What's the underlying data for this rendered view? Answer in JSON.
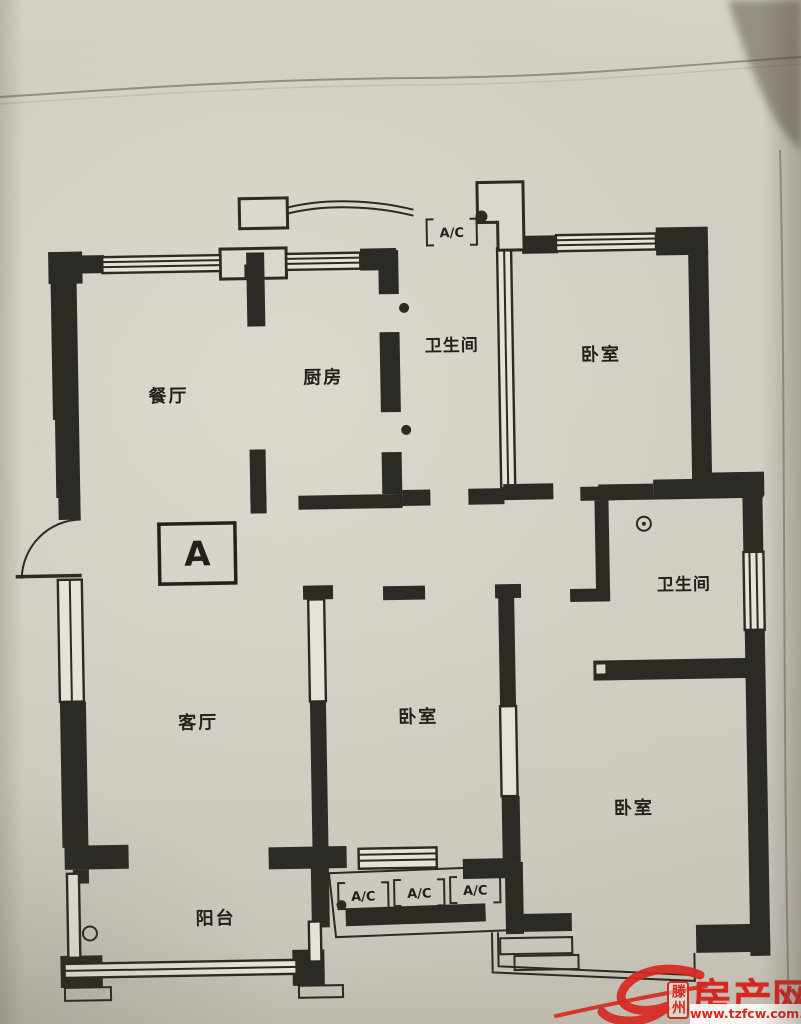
{
  "floorplan": {
    "unit_label": "A",
    "ac_label": "A/C",
    "rooms": [
      {
        "name": "dining-room",
        "label": "餐厅"
      },
      {
        "name": "kitchen",
        "label": "厨房"
      },
      {
        "name": "bathroom-top",
        "label": "卫生间"
      },
      {
        "name": "bedroom-top-right",
        "label": "卧室"
      },
      {
        "name": "bathroom-right",
        "label": "卫生间"
      },
      {
        "name": "living-room",
        "label": "客厅"
      },
      {
        "name": "bedroom-middle",
        "label": "卧室"
      },
      {
        "name": "bedroom-bottom-right",
        "label": "卧室"
      },
      {
        "name": "balcony",
        "label": "阳台"
      }
    ]
  },
  "watermark": {
    "site_badge": "滕州",
    "site_name": "房产网",
    "site_url": "www.tzfcw.com.cn",
    "brand_color": "#d7281f"
  },
  "colors": {
    "wall": "#2c2a24",
    "paper": "#d2cec4"
  }
}
